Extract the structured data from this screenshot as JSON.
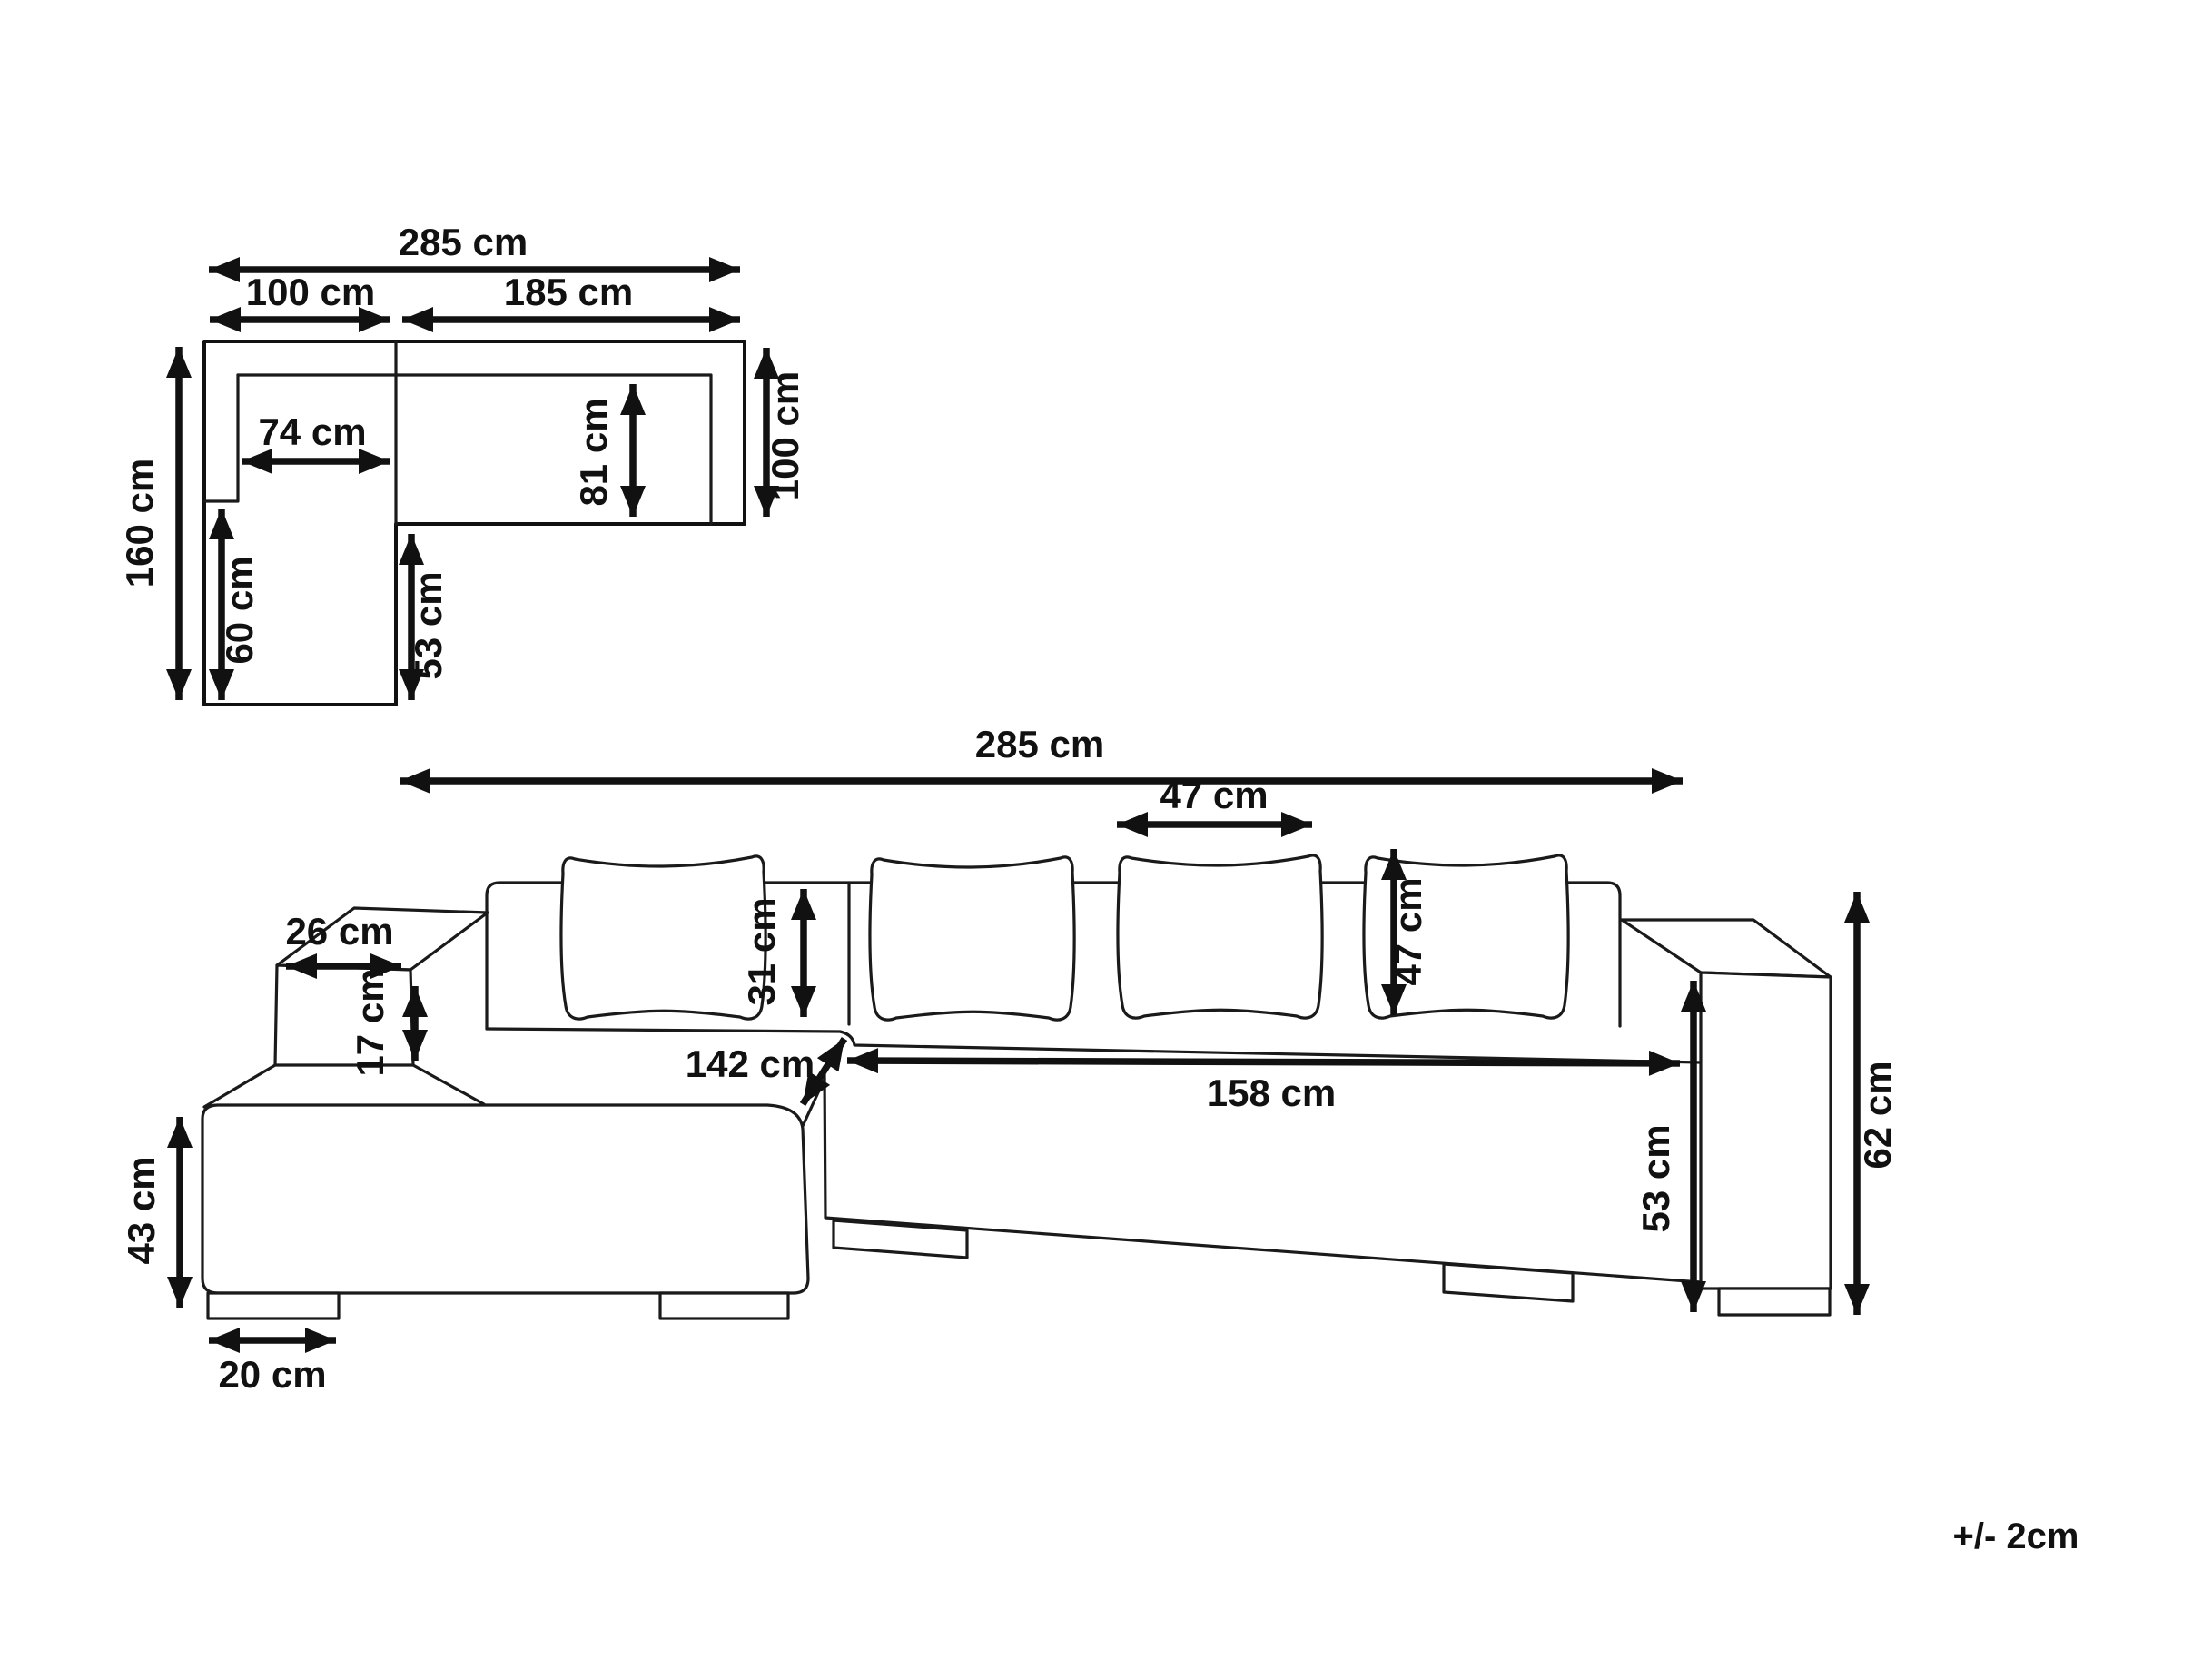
{
  "note": {
    "tolerance": "+/- 2cm"
  },
  "top_view": {
    "dimensions": {
      "total_width": "285 cm",
      "left_section_width": "100 cm",
      "right_section_width": "185 cm",
      "total_depth": "160 cm",
      "left_seat_width": "74 cm",
      "right_seat_depth": "81 cm",
      "right_section_depth": "100 cm",
      "chaise_seat_length": "60 cm",
      "seat_depth": "53 cm"
    }
  },
  "front_view": {
    "dimensions": {
      "total_width": "285 cm",
      "cushion_width": "47 cm",
      "backrest_above_seat_height": "31 cm",
      "cushion_height": "47 cm",
      "armrest_top_depth": "26 cm",
      "armrest_above_seat_height": "17 cm",
      "chaise_length": "142 cm",
      "seat_width": "158 cm",
      "seat_height": "53 cm",
      "armrest_height": "62 cm",
      "chaise_front_height": "43 cm",
      "foot_width": "20 cm"
    }
  }
}
